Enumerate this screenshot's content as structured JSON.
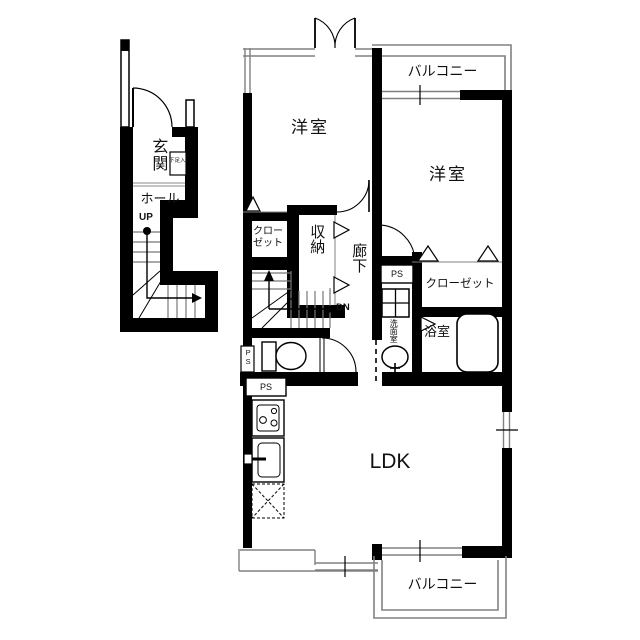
{
  "colors": {
    "wall": "#000000",
    "thin_line": "#808080",
    "background": "#ffffff"
  },
  "labels": {
    "entrance": "玄関",
    "shoe_cabinet": "下足入",
    "hall": "ホール",
    "up": "UP",
    "dn": "DN",
    "room_nw": "洋室",
    "room_ne": "洋室",
    "balcony_north": "バルコニー",
    "balcony_south": "バルコニー",
    "closet_nw": "クローゼット",
    "closet_east": "クローゼット",
    "storage": "収納",
    "corridor": "廊下",
    "washroom": "洗面室",
    "bathroom": "浴室",
    "ldk": "LDK",
    "ps": "PS"
  }
}
